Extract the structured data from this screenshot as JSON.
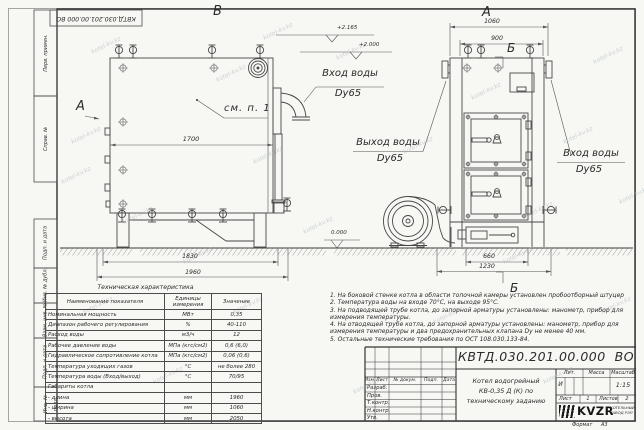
{
  "sheet": {
    "stamp": "КВТД.030.201.00.000  ВО",
    "watermark": "kotel-kv.kz",
    "format_label": "Формат",
    "format_value": "А3"
  },
  "frame_left": {
    "items": [
      "Перв. примен.",
      "Справ. №",
      "Подп. и дата",
      "Инв. № дубл.",
      "Взам. инв. №",
      "Подп. и дата",
      "Инв. № подл."
    ]
  },
  "drawing": {
    "view_b": "В",
    "view_a_side": "А",
    "view_a_top": "А",
    "section_b_top": "Б",
    "section_b_bottom": "Б",
    "callout": "см. п. 1",
    "dims": {
      "d1700": "1700",
      "d1830": "1830",
      "d1960": "1960",
      "d1060": "1060",
      "d900": "900",
      "d660": "660",
      "d1230": "1230"
    },
    "levels": {
      "top": "+2.165",
      "mid": "+2.000",
      "zero": "0.000"
    },
    "labels": {
      "inlet_side_1": "Вход воды",
      "inlet_side_2": "Dy65",
      "outlet_1": "Выход воды",
      "outlet_2": "Dy65",
      "inlet_front_1": "Вход воды",
      "inlet_front_2": "Dy65"
    }
  },
  "notes": [
    "1.  На боковой стенке котла в области топочной камеры установлен пробоотборный штуцер",
    "2.  Температура воды на входе 70°С, на выходе 95°С.",
    "3.  На подводящей трубе котла, до запорной арматуры установлены: манометр, прибор для измерения температуры.",
    "4.  На отводящей трубе котла, до запорной арматуры установлены: манометр, прибор для измерения температуры и два предохранительных клапана  Dу не менее 40 мм.",
    "5.  Остальные технические требования по ОСТ 108.030.133-84."
  ],
  "spec_table": {
    "title": "Техническая характеристика",
    "headers": [
      "Наименование показателя",
      "Единицы\nизмерения",
      "Значение"
    ],
    "rows": [
      [
        "Номинальная мощность",
        "МВт",
        "0,35"
      ],
      [
        "Диапазон рабочего регулирования",
        "%",
        "40-110"
      ],
      [
        "Расход воды",
        "м3/ч",
        "12"
      ],
      [
        "Рабочее давление воды",
        "МПа (кгс/см2)",
        "0,6 (6,0)"
      ],
      [
        "Гидравлическое сопротивление котла",
        "МПа (кгс/см2)",
        "0,06 (0,6)"
      ],
      [
        "Температура уходящих газов",
        "°С",
        "не более 280"
      ],
      [
        "Температура воды (Вход/выход)",
        "°С",
        "70/95"
      ],
      [
        "Габариты котла",
        "",
        ""
      ],
      [
        "- длина",
        "мм",
        "1960"
      ],
      [
        "- ширина",
        "мм",
        "1060"
      ],
      [
        "- высота",
        "мм",
        "2050"
      ]
    ]
  },
  "title_block": {
    "doc_number": "КВТД.030.201.00.000  ВО",
    "title_lines": [
      "Котел водогрейный",
      "КВ-0,35 Д (К) по",
      "техническому заданию"
    ],
    "cols": [
      "Изм.",
      "Лист",
      "№ докум.",
      "Подп.",
      "Дата"
    ],
    "rows": [
      "Разраб.",
      "Пров.",
      "Т.контр.",
      "Н.контр.",
      "Утв."
    ],
    "lit_label": "Лит.",
    "lit_value": "И",
    "mass_label": "Масса",
    "scale_label": "Масштаб",
    "scale_value": "1:15",
    "sheet_label": "Лист",
    "sheet_value": "1",
    "sheets_label": "Листов",
    "sheets_value": "2",
    "logo": "KVZR",
    "company1": "КОТЕЛЬНЫЙ",
    "company2": "ЗАВОД РЭП"
  }
}
